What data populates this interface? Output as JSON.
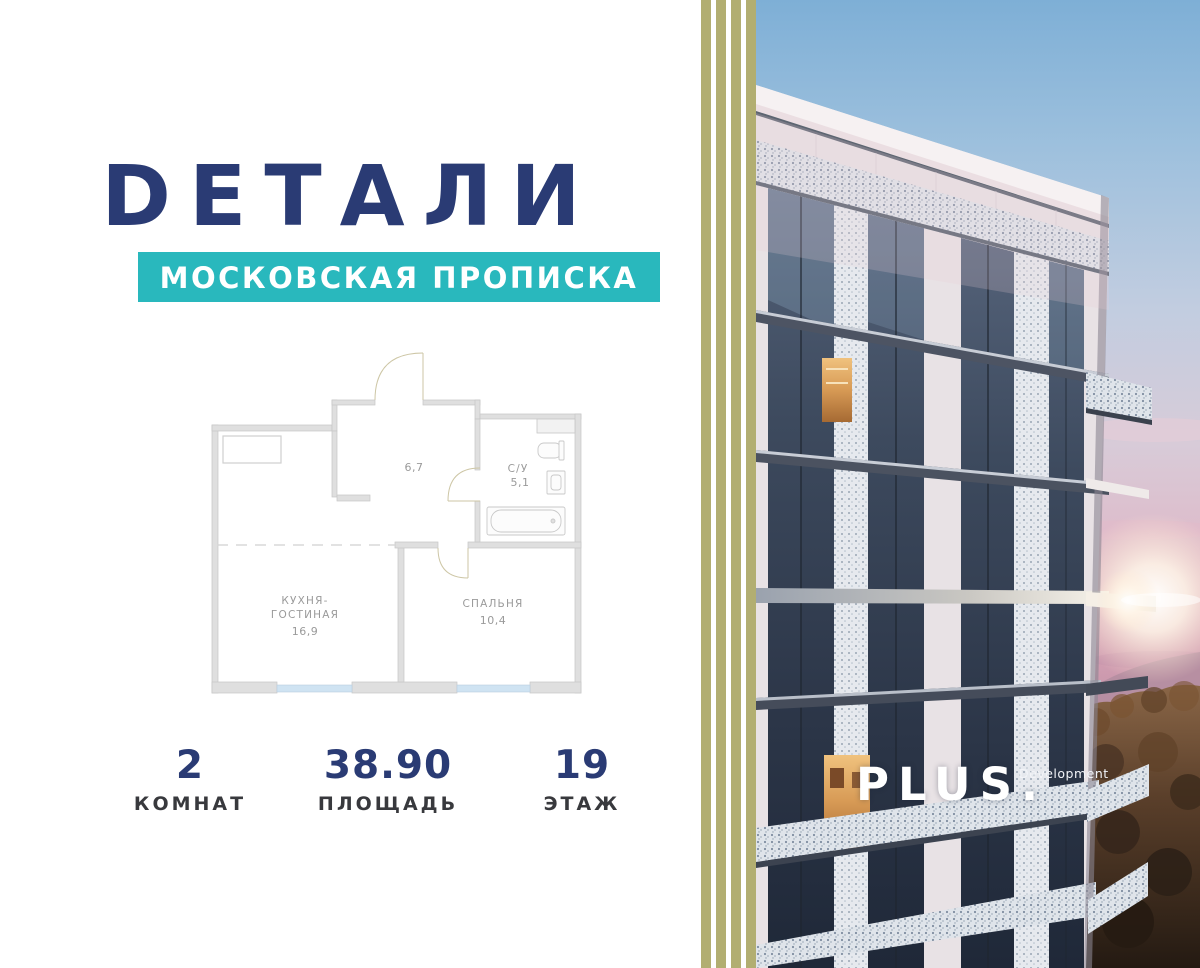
{
  "brand": {
    "logo": "DЕТАЛИ",
    "tagline": "МОСКОВСКАЯ ПРОПИСКА"
  },
  "plan": {
    "hallway_area": "6,7",
    "bathroom": {
      "name": "С/У",
      "area": "5,1"
    },
    "kitchen": {
      "name_line1": "КУХНЯ-",
      "name_line2": "ГОСТИНАЯ",
      "area": "16,9"
    },
    "bedroom": {
      "name": "СПАЛЬНЯ",
      "area": "10,4"
    }
  },
  "stats": [
    {
      "value": "2",
      "label": "КОМНАТ"
    },
    {
      "value": "38.90",
      "label": "ПЛОЩАДЬ"
    },
    {
      "value": "19",
      "label": "ЭТАЖ"
    }
  ],
  "developer": {
    "brand": "PLUS.",
    "suffix": "Development"
  },
  "palette": {
    "navy": "#2a3b74",
    "teal": "#29b8bd",
    "stripe_olive": "#b2ae71",
    "stat_label_gray": "#38393d",
    "plan_label_gray": "#9a9a9a",
    "plan_window_blue": "#cfe3f2",
    "plan_wall_gray": "#dfdfdf"
  }
}
